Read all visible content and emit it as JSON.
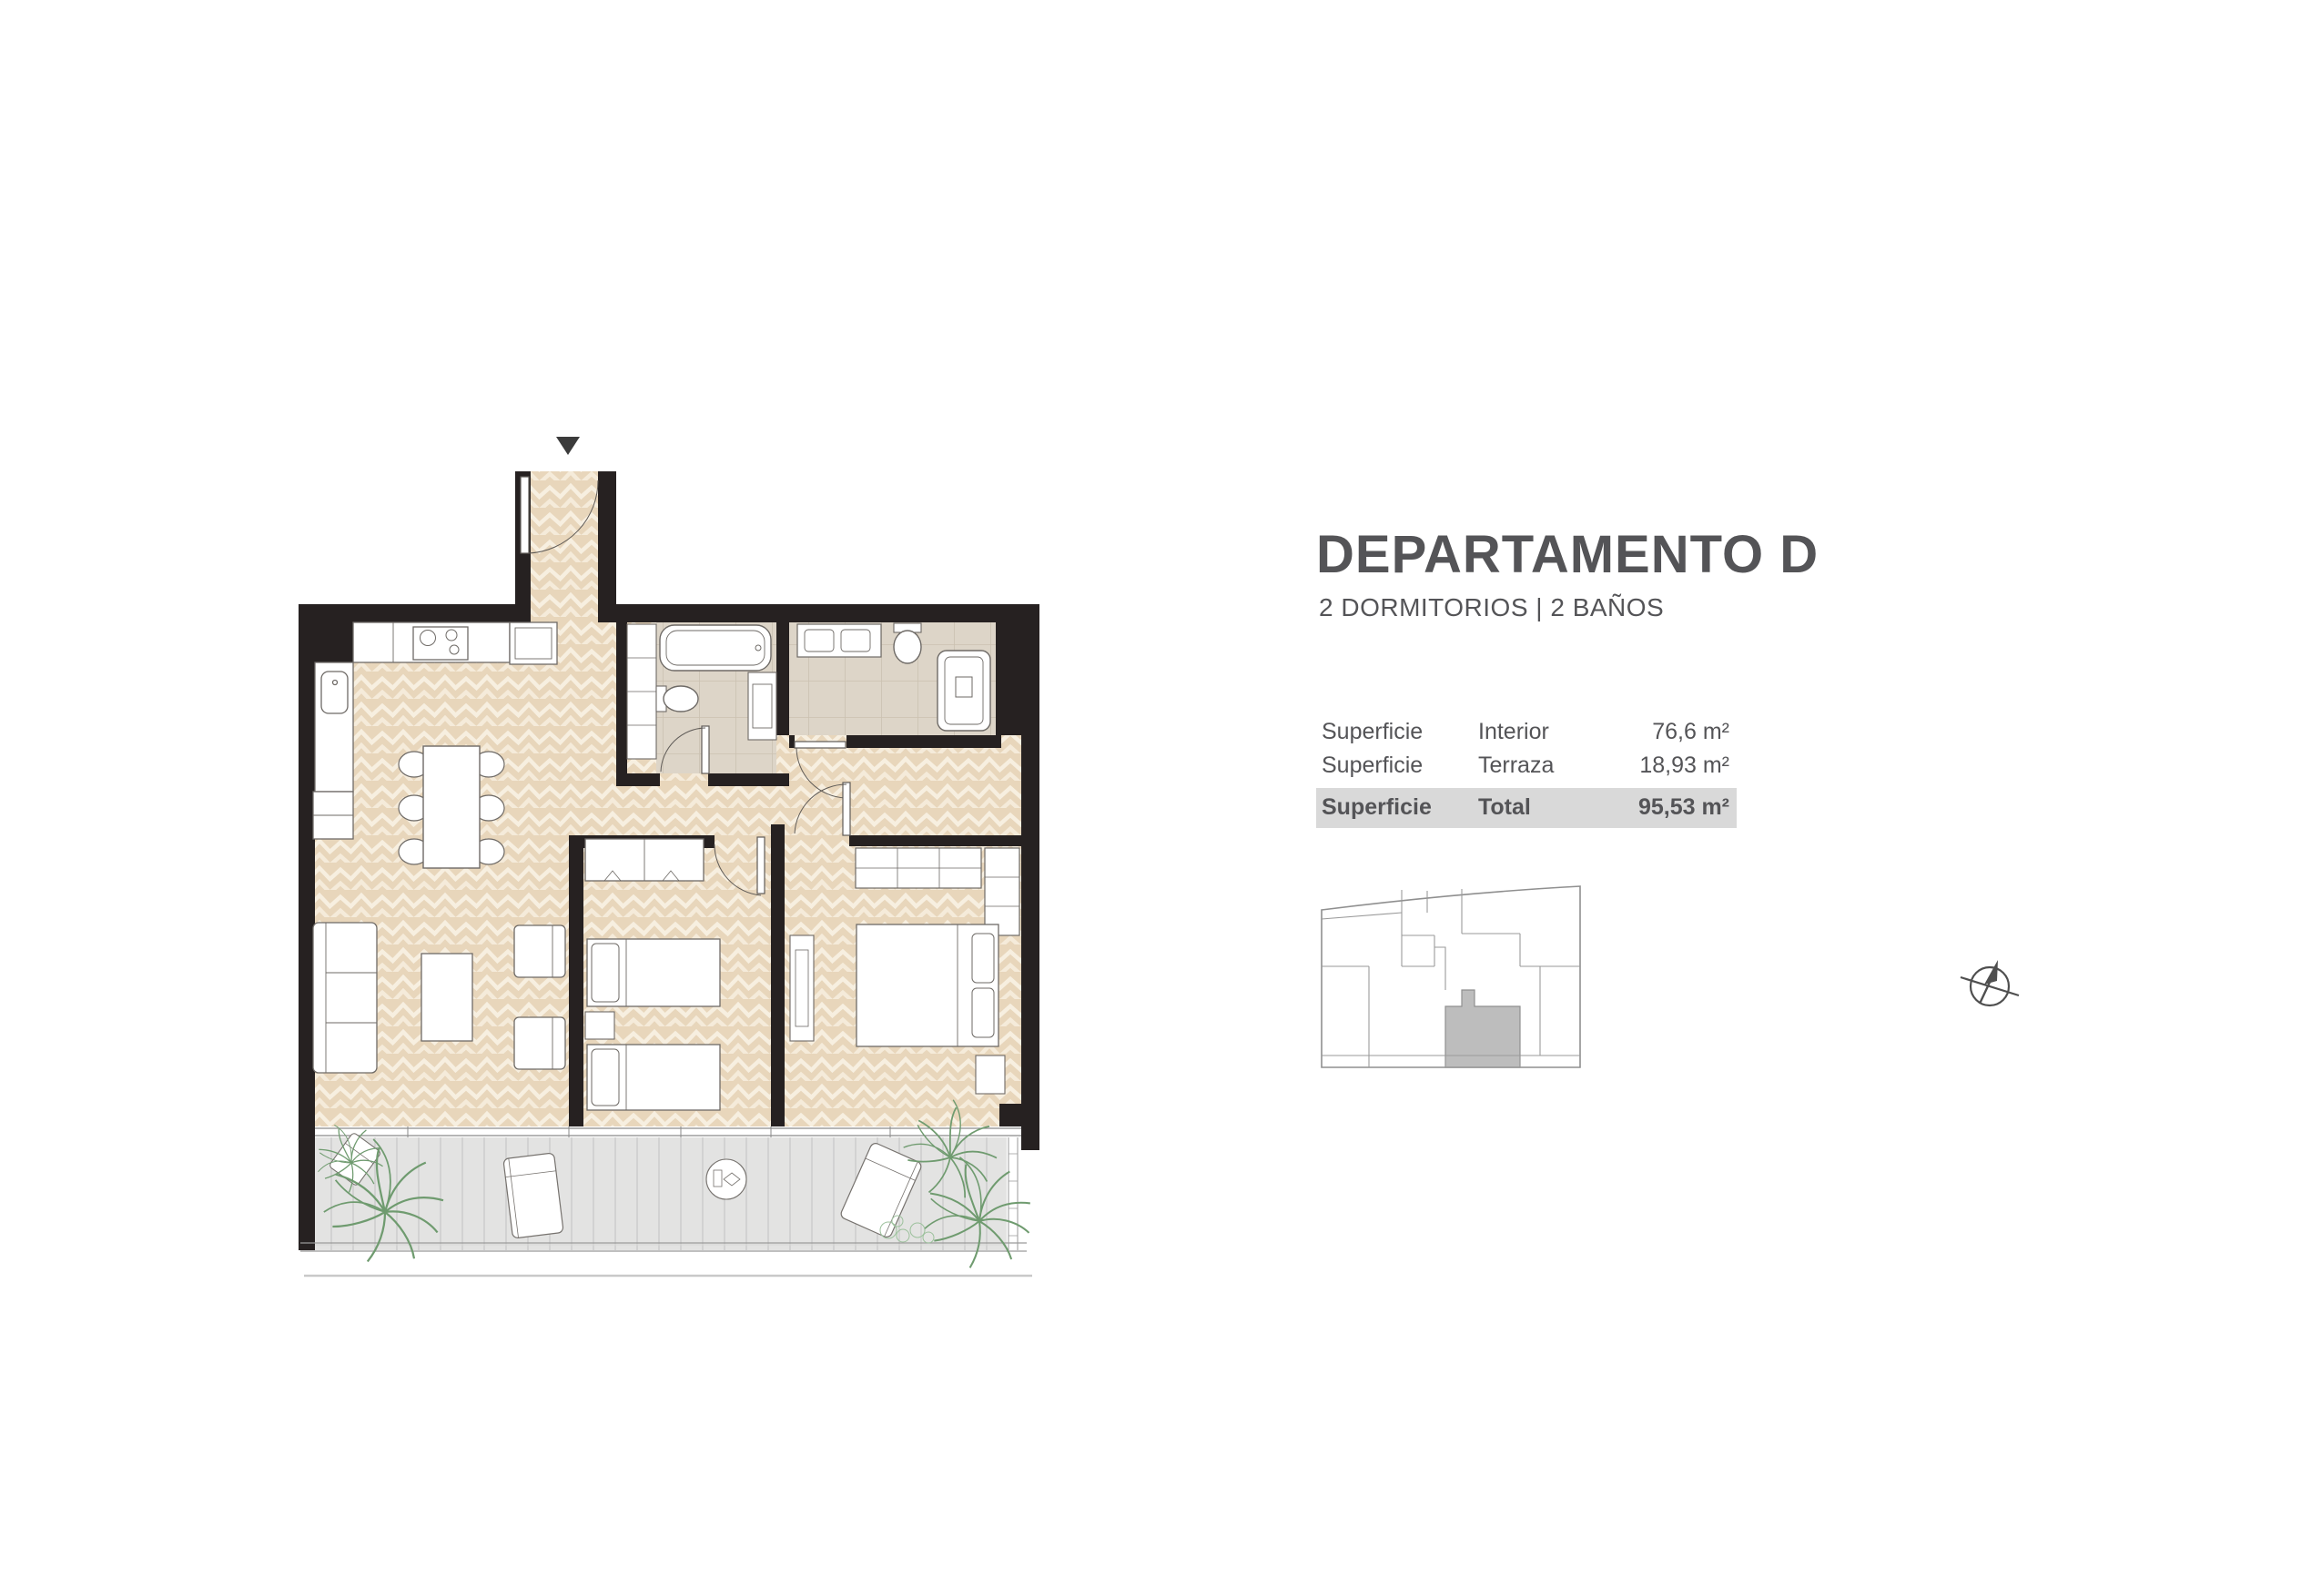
{
  "header": {
    "title": "DEPARTAMENTO D",
    "subtitle": "2 DORMITORIOS | 2 BAÑOS"
  },
  "surface_table": {
    "rows": [
      {
        "label": "Superficie",
        "concept": "Interior",
        "value": "76,6 m²"
      },
      {
        "label": "Superficie",
        "concept": "Terraza",
        "value": "18,93 m²"
      },
      {
        "label": "Superficie",
        "concept": "Total",
        "value": "95,53 m²"
      }
    ]
  },
  "floor_plan": {
    "entrance_marker": "down-triangle-icon",
    "rooms_depicted": "open kitchen-dining-living, hallway, 2 bathrooms, 2 bedrooms, terrace with plants"
  },
  "key_plan": {
    "description": "building key plan with highlighted unit",
    "highlight_color": "#bdbdbd"
  },
  "compass": {
    "icon": "compass-north-icon"
  },
  "colors": {
    "text": "#545457",
    "highlight_row": "#d9d9d9",
    "wall": "#262121",
    "floor_interior": "#e8d6bb",
    "floor_bath": "#ddd5c8",
    "floor_terrace": "#e3e3e2",
    "plant": "#6f9b6f"
  }
}
